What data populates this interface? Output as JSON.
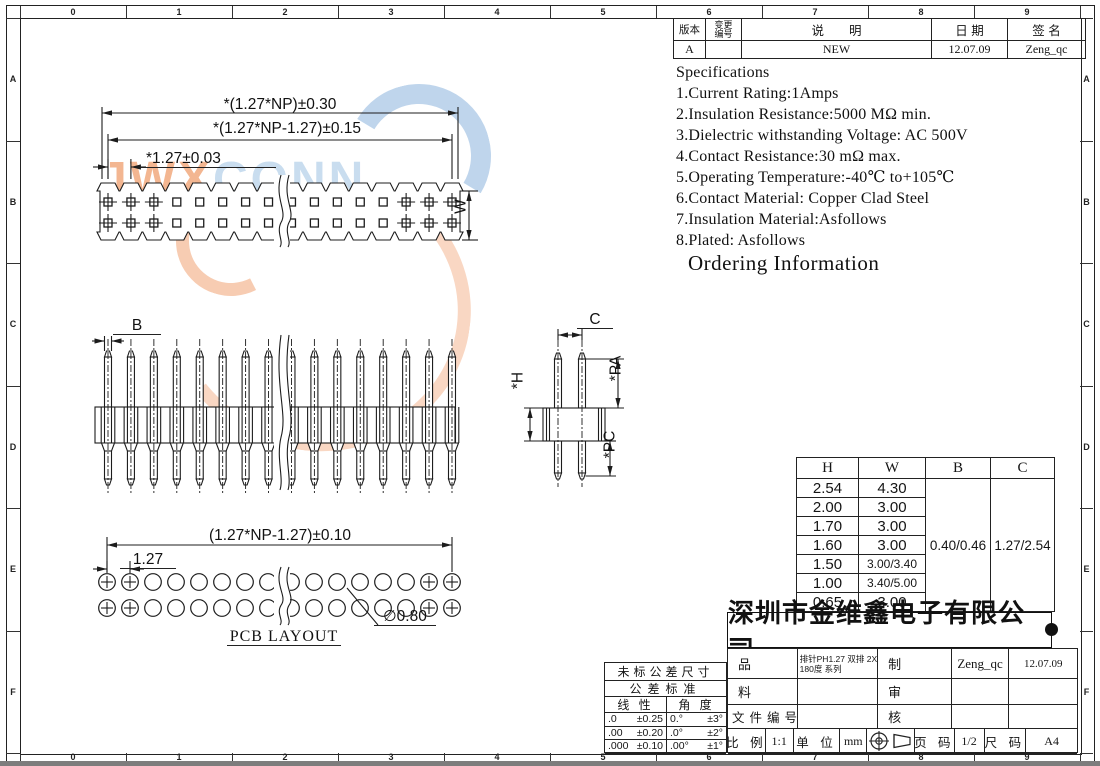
{
  "border": {
    "top_numbers": [
      "0",
      "1",
      "2",
      "3",
      "4",
      "5",
      "6",
      "7",
      "8",
      "9"
    ],
    "side_letters": [
      "A",
      "B",
      "C",
      "D",
      "E",
      "F"
    ]
  },
  "revision_table": {
    "version_label": "版本",
    "change_label_1": "变更",
    "change_label_2": "编号",
    "desc_label": "说　　明",
    "date_label": "日 期",
    "sign_label": "签 名",
    "rows": [
      {
        "version": "A",
        "change": "",
        "desc": "NEW",
        "date": "12.07.09",
        "sign": "Zeng_qc"
      }
    ]
  },
  "specifications": {
    "title": "Specifications",
    "items": [
      "1.Current Rating:1Amps",
      "2.Insulation Resistance:5000 MΩ min.",
      "3.Dielectric withstanding Voltage: AC 500V",
      "4.Contact Resistance:30 mΩ max.",
      "5.Operating Temperature:-40℃ to+105℃",
      "6.Contact Material: Copper Clad Steel",
      "7.Insulation Material:Asfollows",
      "8.Plated: Asfollows"
    ]
  },
  "ordering_title": "Ordering Information",
  "watermark": {
    "part1": "JWX",
    "part2": "CONN",
    "orange": "#ec8a4e",
    "blue": "#a9c9e6"
  },
  "dims": {
    "tv_overall": "*(1.27*NP)±0.30",
    "tv_inner": "*(1.27*NP-1.27)±0.15",
    "tv_pitch": "*1.27±0.03",
    "tv_w": "W",
    "sv_b": "B",
    "ev_c": "C",
    "ev_pa": "*PA",
    "ev_h": "*H",
    "ev_pc": "*PC",
    "pcb_overall": "(1.27*NP-1.27)±0.10",
    "pcb_pitch": "1.27",
    "pcb_hole": "∅0.80",
    "pcb_label": "PCB LAYOUT"
  },
  "size_table": {
    "headers": [
      "H",
      "W",
      "B",
      "C"
    ],
    "rows": [
      [
        "2.54",
        "4.30"
      ],
      [
        "2.00",
        "3.00"
      ],
      [
        "1.70",
        "3.00"
      ],
      [
        "1.60",
        "3.00"
      ],
      [
        "1.50",
        "3.00/3.40"
      ],
      [
        "1.00",
        "3.40/5.00"
      ],
      [
        "0.65",
        "3.00"
      ]
    ],
    "b_value": "0.40/0.46",
    "c_value": "1.27/2.54"
  },
  "company": "深圳市金维鑫电子有限公司",
  "title_block": {
    "product_label": "品 名",
    "product_line1": "排针PH1.27 双排 2XNP",
    "product_line2": "180度  系列",
    "material_label": "料 号",
    "file_label": "文件编号",
    "drawn_label": "制 图",
    "drawn_by": "Zeng_qc",
    "drawn_date": "12.07.09",
    "review_label": "审 核",
    "approve_label": "核 准",
    "scale_label": "比 例",
    "scale": "1:1",
    "unit_label": "单 位",
    "unit": "mm",
    "page_label": "页 码",
    "page": "1/2",
    "size_label": "尺 码",
    "size": "A4"
  },
  "tolerance": {
    "title1": "未标公差尺寸",
    "title2": "公差标准",
    "linear_label": "线 性",
    "angle_label": "角 度",
    "rows": [
      [
        ".0",
        "±0.25",
        "0.°",
        "±3°"
      ],
      [
        ".00",
        "±0.20",
        ".0°",
        "±2°"
      ],
      [
        ".000",
        "±0.10",
        ".00°",
        "±1°"
      ]
    ]
  }
}
